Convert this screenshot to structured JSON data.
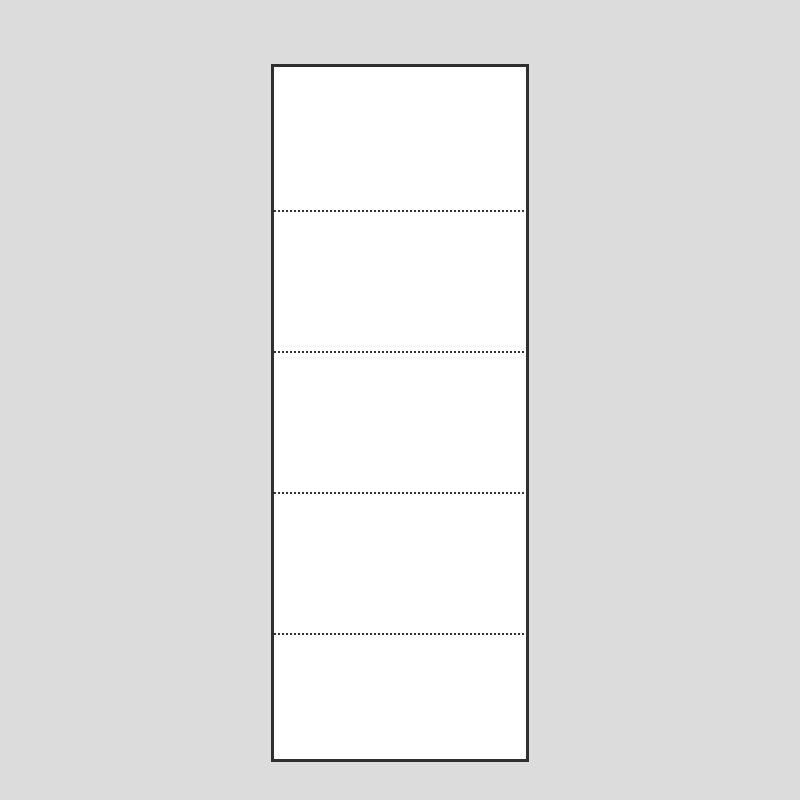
{
  "diagram": {
    "kind": "blank-perforated-sheet",
    "paper": {
      "panel_count": 5,
      "perforation_line_count": 4,
      "panel_heights_px": [
        143,
        139,
        139,
        139,
        124
      ]
    },
    "colors": {
      "background": "#dcdcdc",
      "paper_fill": "#ffffff",
      "border": "#2f2f2f",
      "perforation": "#333333"
    }
  }
}
